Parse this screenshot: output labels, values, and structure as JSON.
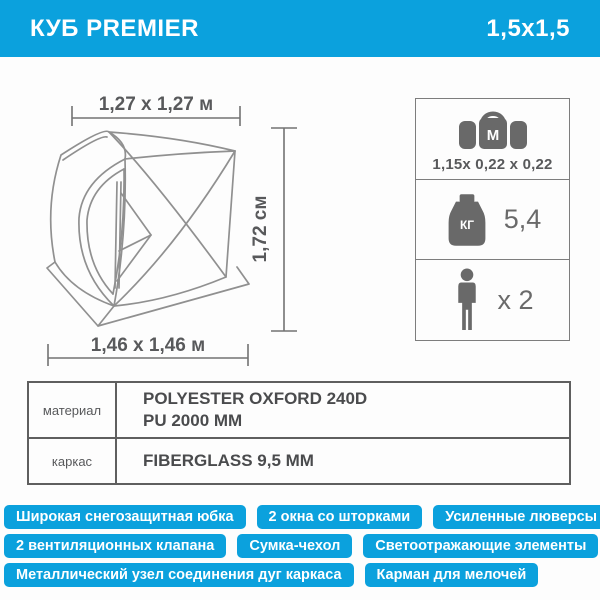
{
  "header": {
    "title": "КУБ PREMIER",
    "size_label": "1,5x1,5"
  },
  "diagram": {
    "width_top": "1,27 х 1,27 м",
    "height_side": "1,72 см",
    "width_bottom": "1,46 х 1,46 м"
  },
  "specs": {
    "packed_size": {
      "icon": "bag-icon",
      "bag_letter": "М",
      "value": "1,15х 0,22 х 0,22"
    },
    "weight": {
      "icon": "weight-icon",
      "unit": "КГ",
      "value": "5,4"
    },
    "capacity": {
      "icon": "person-icon",
      "value": "х 2"
    }
  },
  "table": {
    "rows": [
      {
        "label": "материал",
        "lines": [
          "POLYESTER OXFORD 240D",
          "PU 2000 MM"
        ]
      },
      {
        "label": "каркас",
        "lines": [
          "FIBERGLASS 9,5 MM"
        ]
      }
    ]
  },
  "features": [
    [
      "Широкая снегозащитная юбка",
      "2 окна со шторками",
      "Усиленные люверсы 12 мм"
    ],
    [
      "2 вентиляционных клапана",
      "Сумка-чехол",
      "Светоотражающие элементы"
    ],
    [
      "Металлический узел соединения дуг каркаса",
      "Карман для мелочей"
    ]
  ],
  "colors": {
    "accent_blue": "#0ba1dd",
    "icon_gray": "#696969",
    "text_gray": "#58595b",
    "tent_line_gray": "#909090",
    "badge_text": "#ffffff"
  }
}
